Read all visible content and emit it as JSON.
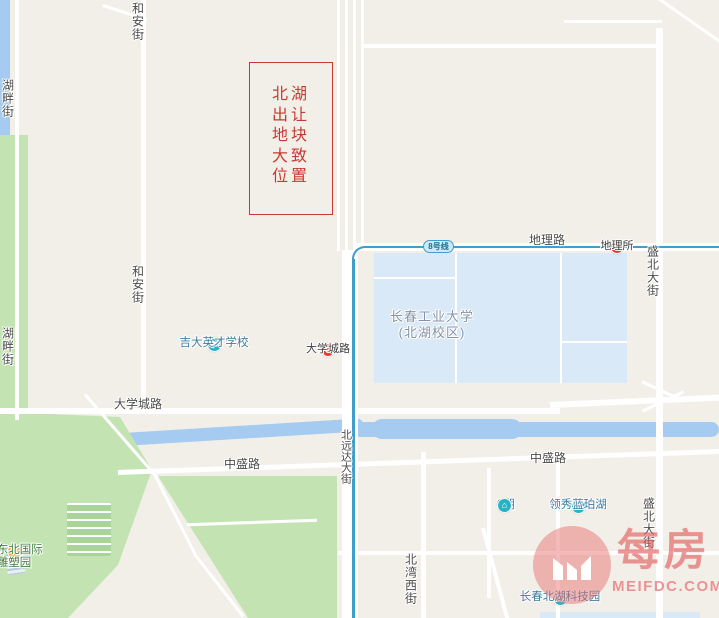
{
  "map": {
    "annotation": {
      "lines": [
        "北湖",
        "出让",
        "地块",
        "大致",
        "位置"
      ]
    },
    "metro": {
      "line_badge": "8号线"
    },
    "watermark": {
      "name_cn": "每房",
      "domain": "MEIFDC.COM"
    },
    "colors": {
      "background": "#f2efe9",
      "water": "#a6cbf0",
      "park_green": "#c3e4b2",
      "campus_fill": "#d9e9f7",
      "metro_blue": "#3f9ecb",
      "station_red": "#e23d3a",
      "poi_teal": "#29b2c6",
      "poi_orange": "#f0a93c",
      "annotation_red": "#c63a31",
      "watermark_red": "#e66767"
    },
    "labels": [
      {
        "name": "road-label-heanjie-top",
        "text": "和安街",
        "x": 137,
        "y": 2,
        "orient": "v",
        "cls": "road"
      },
      {
        "name": "road-label-hupanjie-top",
        "text": "湖畔街",
        "x": 7,
        "y": 79,
        "orient": "v",
        "cls": "road"
      },
      {
        "name": "road-label-heanjie-mid",
        "text": "和安街",
        "x": 137,
        "y": 265,
        "orient": "v",
        "cls": "road"
      },
      {
        "name": "road-label-hupanjie-bottom",
        "text": "湖畔街",
        "x": 7,
        "y": 327,
        "orient": "v",
        "cls": "road"
      },
      {
        "name": "road-label-dililu",
        "text": "地理路",
        "x": 547,
        "y": 234,
        "orient": "h",
        "cls": "road"
      },
      {
        "name": "road-label-shengbei-top",
        "text": "盛北大街",
        "x": 652,
        "y": 245,
        "orient": "v",
        "cls": "road"
      },
      {
        "name": "road-label-daxuecheng",
        "text": "大学城路",
        "x": 138,
        "y": 398,
        "orient": "h",
        "cls": "road"
      },
      {
        "name": "road-label-beiyuanda",
        "text": "北远达大街",
        "x": 345,
        "y": 429,
        "orient": "v",
        "cls": "road onroad"
      },
      {
        "name": "road-label-zhongsheng-west",
        "text": "中盛路",
        "x": 242,
        "y": 458,
        "orient": "h",
        "cls": "road"
      },
      {
        "name": "road-label-zhongsheng-east",
        "text": "中盛路",
        "x": 548,
        "y": 452,
        "orient": "h",
        "cls": "road"
      },
      {
        "name": "road-label-beiwanxi",
        "text": "北湾西街",
        "x": 410,
        "y": 553,
        "orient": "v",
        "cls": "road"
      },
      {
        "name": "road-label-shengbei-bottom",
        "text": "盛北大街",
        "x": 648,
        "y": 497,
        "orient": "v",
        "cls": "road"
      },
      {
        "name": "campus-label-ccut",
        "text": "长春工业大学\n(北湖校区)",
        "x": 432,
        "y": 309,
        "orient": "h",
        "cls": "campus"
      },
      {
        "name": "station-dilisuo",
        "text": "地理所",
        "x": 617,
        "y": 240,
        "orient": "h",
        "cls": "station",
        "icon": "metro-station-icon",
        "interactable": true
      },
      {
        "name": "station-daxuechenglu",
        "text": "大学城路",
        "x": 328,
        "y": 343,
        "orient": "h",
        "cls": "station",
        "icon": "metro-station-icon",
        "interactable": true
      },
      {
        "name": "poi-jida-yingcai-school",
        "text": "吉大英才学校",
        "x": 214,
        "y": 337,
        "orient": "h",
        "cls": "poi-blue",
        "icon": "school-icon",
        "interactable": true
      },
      {
        "name": "poi-2qi",
        "text": "2期",
        "x": 497,
        "y": 505,
        "orient": "h",
        "cls": "poi-blue row",
        "icon": "residence-icon",
        "iconPos": "right",
        "interactable": true
      },
      {
        "name": "poi-lingxiu-lanpohu",
        "text": "领秀蓝珀湖",
        "x": 578,
        "y": 499,
        "orient": "h",
        "cls": "poi-blue",
        "icon": "residence-icon",
        "interactable": true
      },
      {
        "name": "poi-sculpture-park",
        "text": "长东北国际\n雕塑园",
        "x": 14,
        "y": 544,
        "orient": "h",
        "cls": "poi-green",
        "icon": "park-icon",
        "interactable": true
      },
      {
        "name": "poi-tech-park",
        "text": "长春北湖科技园",
        "x": 560,
        "y": 591,
        "orient": "h",
        "cls": "poi-blue",
        "icon": "tech-park-icon",
        "interactable": true
      }
    ]
  }
}
